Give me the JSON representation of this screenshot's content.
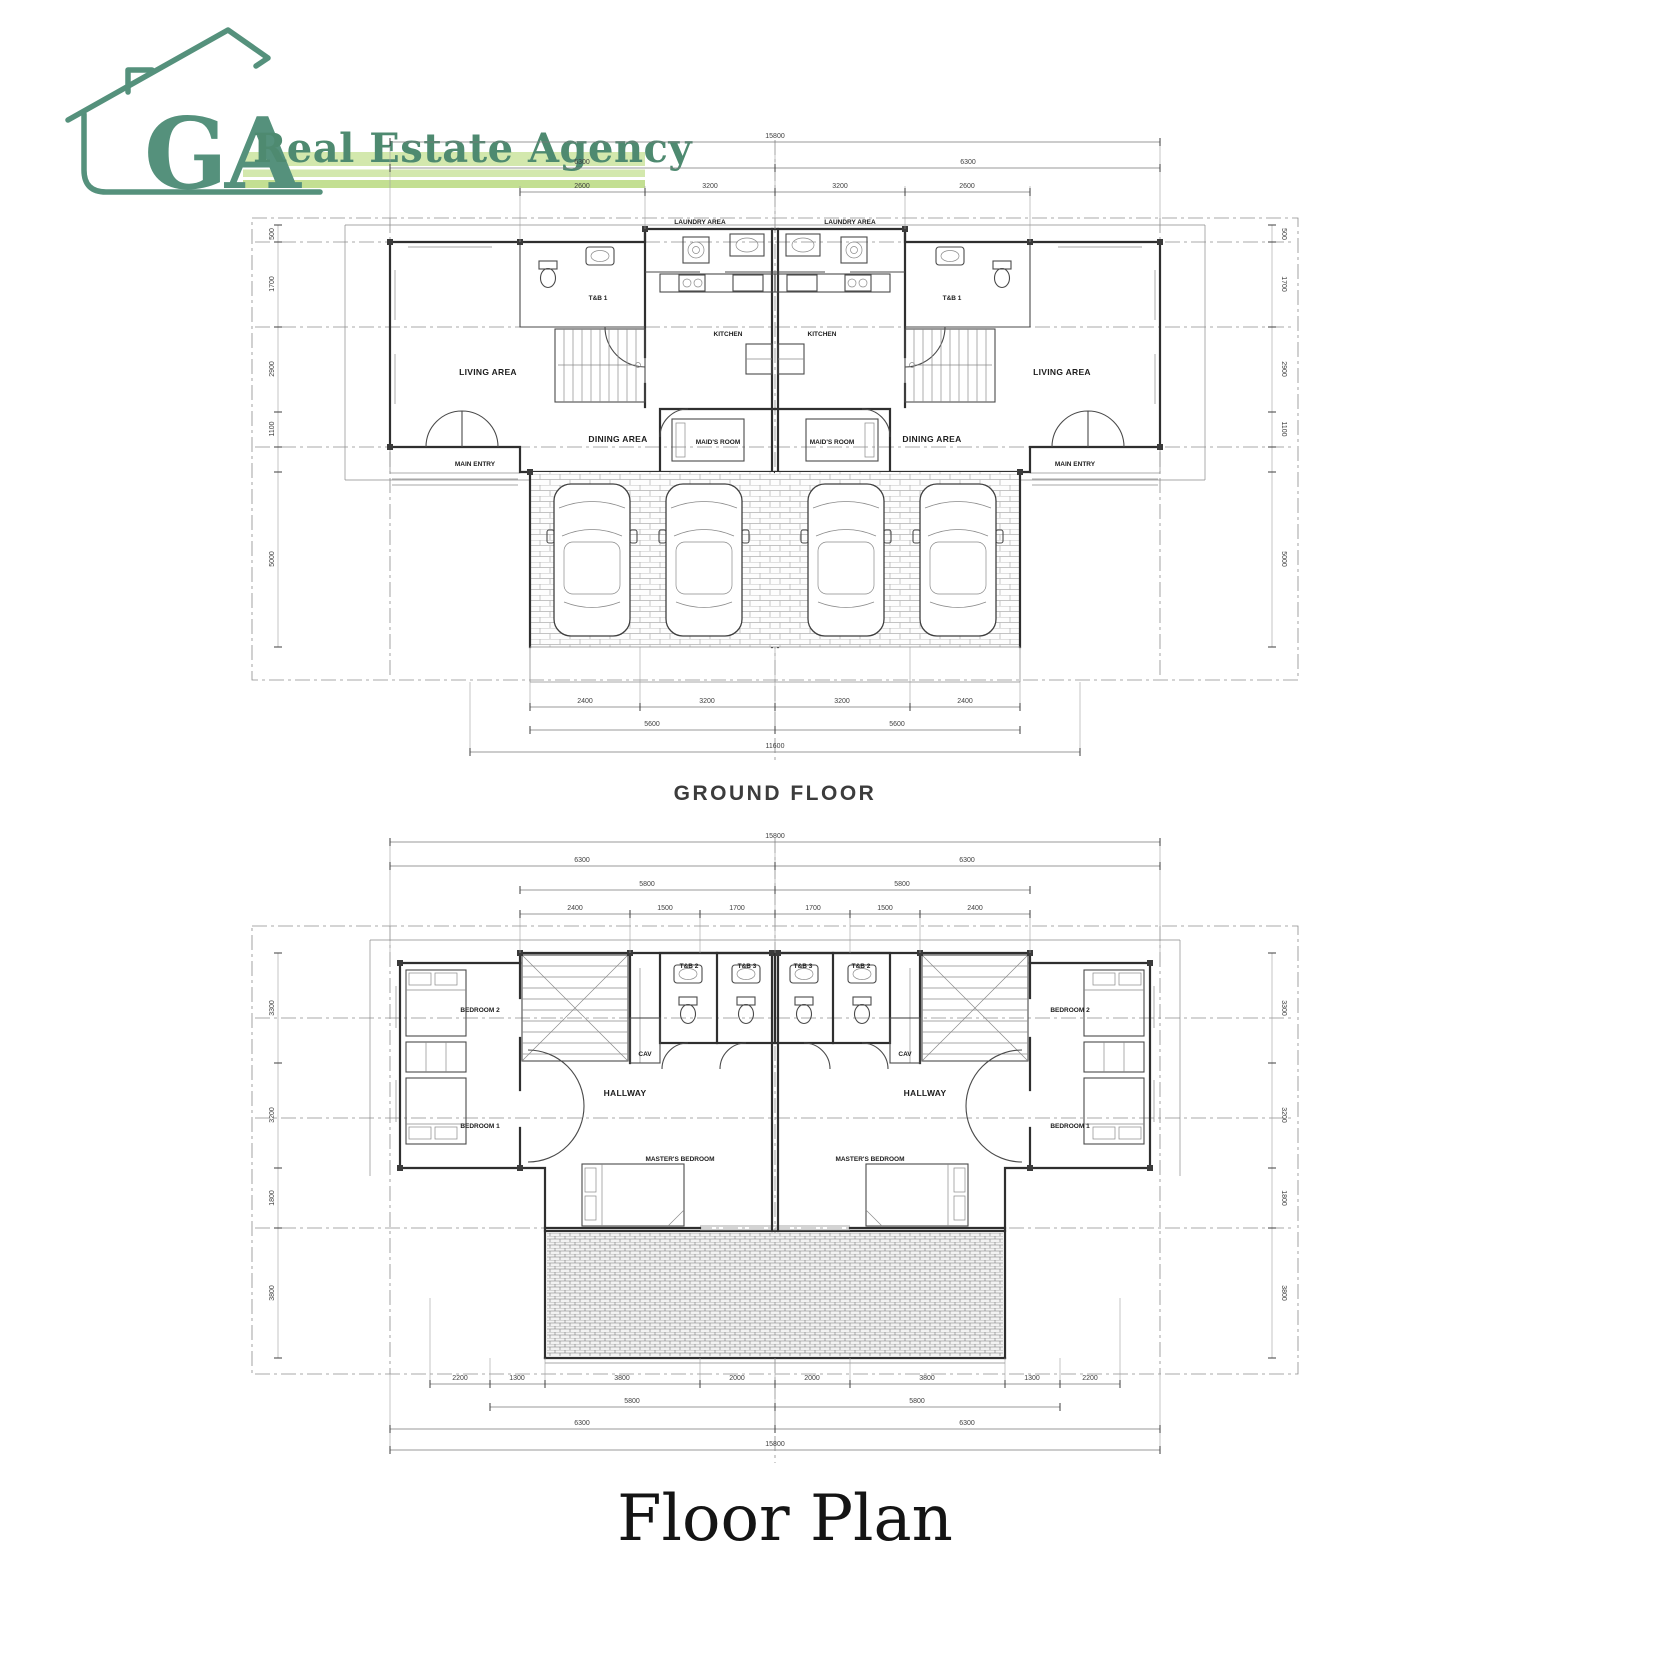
{
  "colors": {
    "brand_green": "#55917c",
    "band_green_light": "#d3e8ad",
    "band_green_dark": "#c3df92",
    "wall_line": "#2f2f2f",
    "dim_line": "#7a7a7a"
  },
  "logo": {
    "monogram": "GA",
    "agency_name": "Real Estate Agency"
  },
  "titles": {
    "ground_floor": "GROUND FLOOR",
    "page_title": "Floor Plan"
  },
  "ground_floor": {
    "rooms": {
      "laundry": "LAUNDRY AREA",
      "tb1": "T&B 1",
      "kitchen": "KITCHEN",
      "living": "LIVING AREA",
      "dining": "DINING AREA",
      "maids": "MAID'S ROOM",
      "entry": "MAIN ENTRY"
    },
    "dims": {
      "top": [
        "15800",
        "6300",
        "6300",
        "2600",
        "3200",
        "3200",
        "2600"
      ],
      "bottom": [
        "2400",
        "3200",
        "3200",
        "2400",
        "5600",
        "5600",
        "11600"
      ],
      "side": [
        "500",
        "1700",
        "2900",
        "1100",
        "5000"
      ]
    }
  },
  "second_floor": {
    "rooms": {
      "bedroom2": "BEDROOM 2",
      "bedroom1": "BEDROOM 1",
      "tb2": "T&B 2",
      "tb3": "T&B 3",
      "cav": "CAV",
      "hallway": "HALLWAY",
      "master": "MASTER'S BEDROOM"
    },
    "dims": {
      "top": [
        "15800",
        "6300",
        "6300",
        "5800",
        "5800",
        "2400",
        "1500",
        "1700",
        "1700",
        "1500",
        "2400"
      ],
      "bottom": [
        "2200",
        "1300",
        "3800",
        "2000",
        "2000",
        "3800",
        "1300",
        "2200",
        "5800",
        "5800",
        "6300",
        "6300",
        "15800"
      ],
      "side": [
        "3300",
        "3200",
        "1800",
        "3800"
      ]
    }
  }
}
